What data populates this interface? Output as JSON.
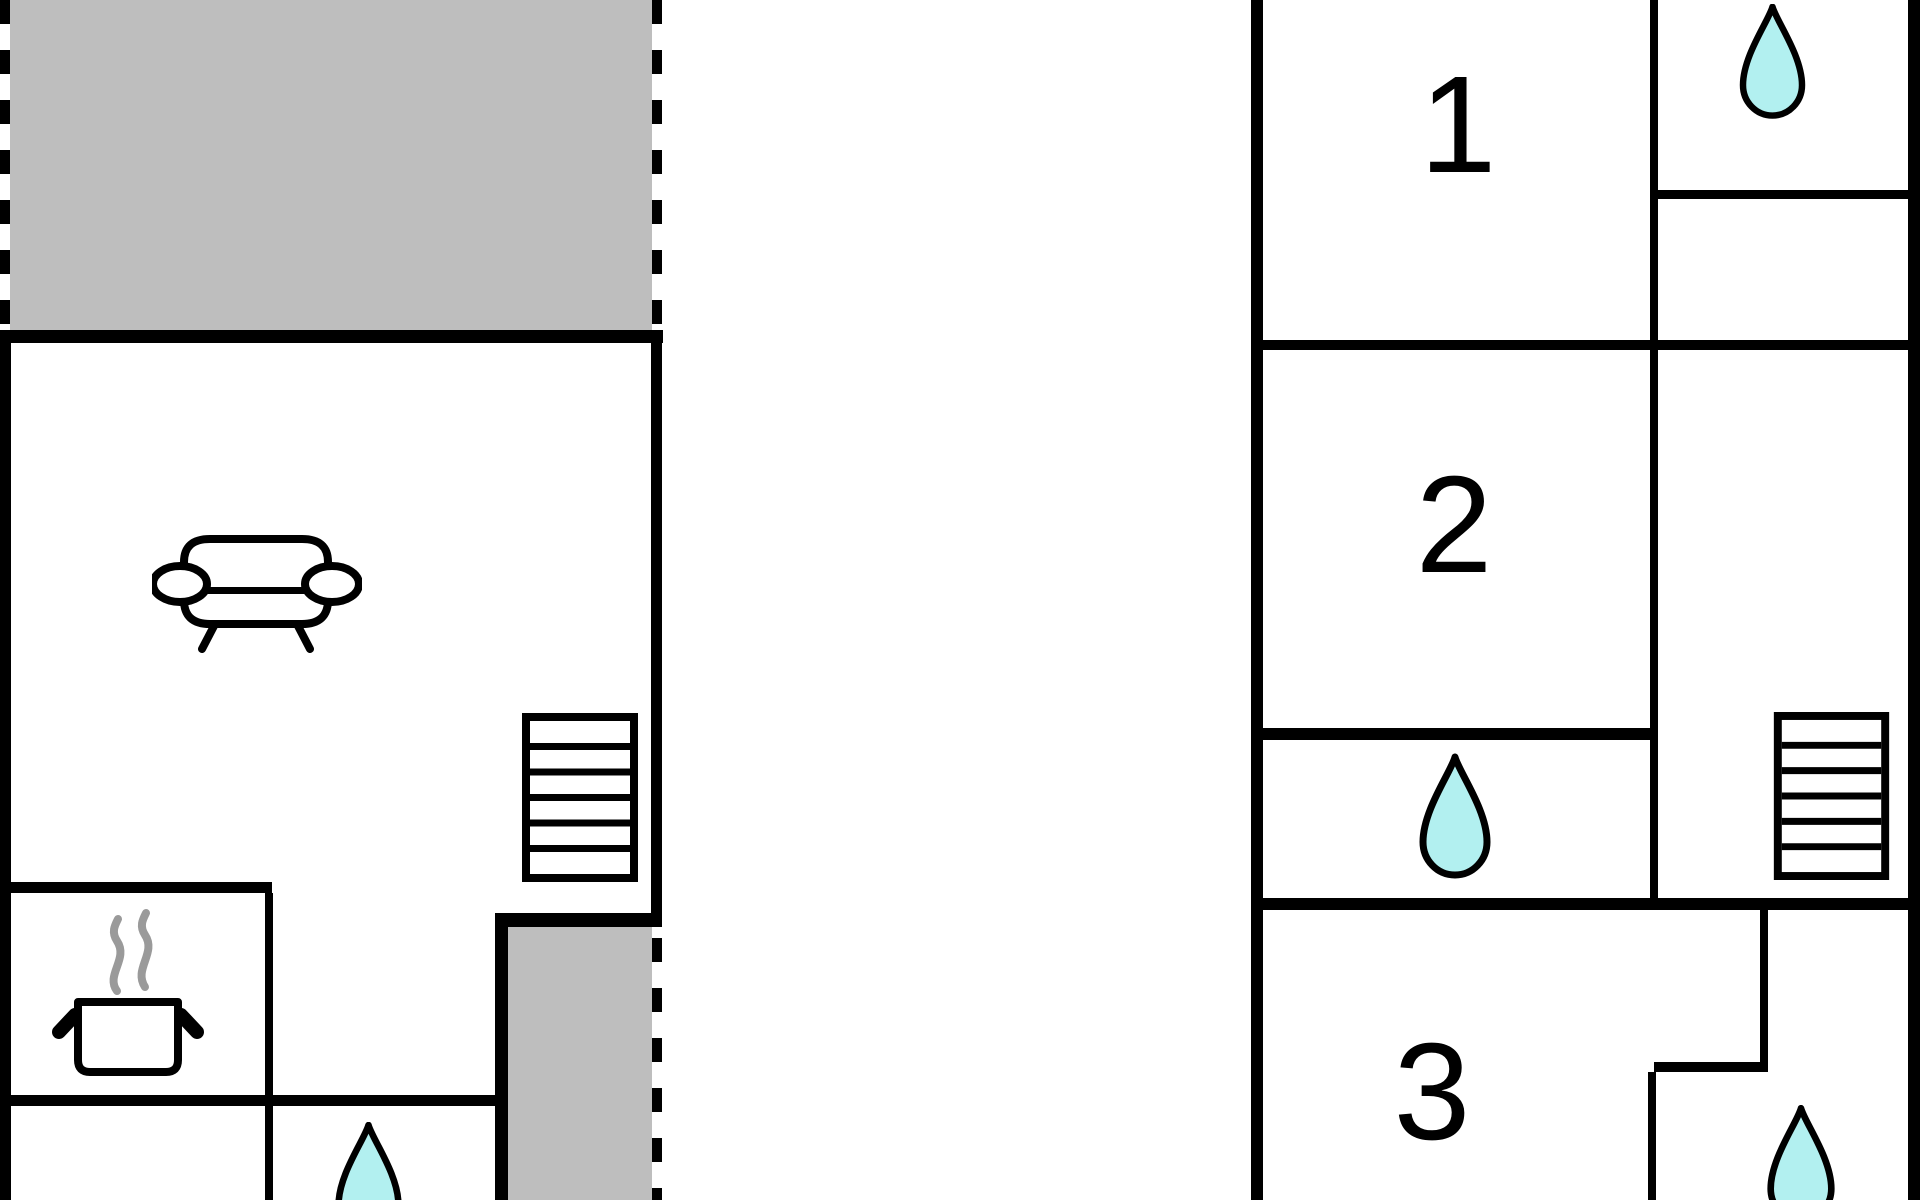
{
  "colors": {
    "background": "#ffffff",
    "wall": "#000000",
    "terrace_fill": "#bebebe",
    "drop_fill": "#b2f0f0",
    "steam": "#9a9a9a"
  },
  "ground_floor": {
    "terraces": [
      {
        "id": "terrace-top",
        "boundary": "dashed"
      },
      {
        "id": "terrace-bottom-right",
        "boundary": "dashed"
      }
    ],
    "icons": [
      {
        "name": "sofa-icon"
      },
      {
        "name": "stairs-icon",
        "steps": 6
      },
      {
        "name": "cooking-pot-icon"
      },
      {
        "name": "water-drop-icon"
      }
    ]
  },
  "upper_floor": {
    "rooms": [
      {
        "label": "1"
      },
      {
        "label": "2"
      },
      {
        "label": "3"
      }
    ],
    "icons": [
      {
        "name": "water-drop-icon",
        "count": 3
      },
      {
        "name": "stairs-icon",
        "steps": 6
      }
    ]
  }
}
